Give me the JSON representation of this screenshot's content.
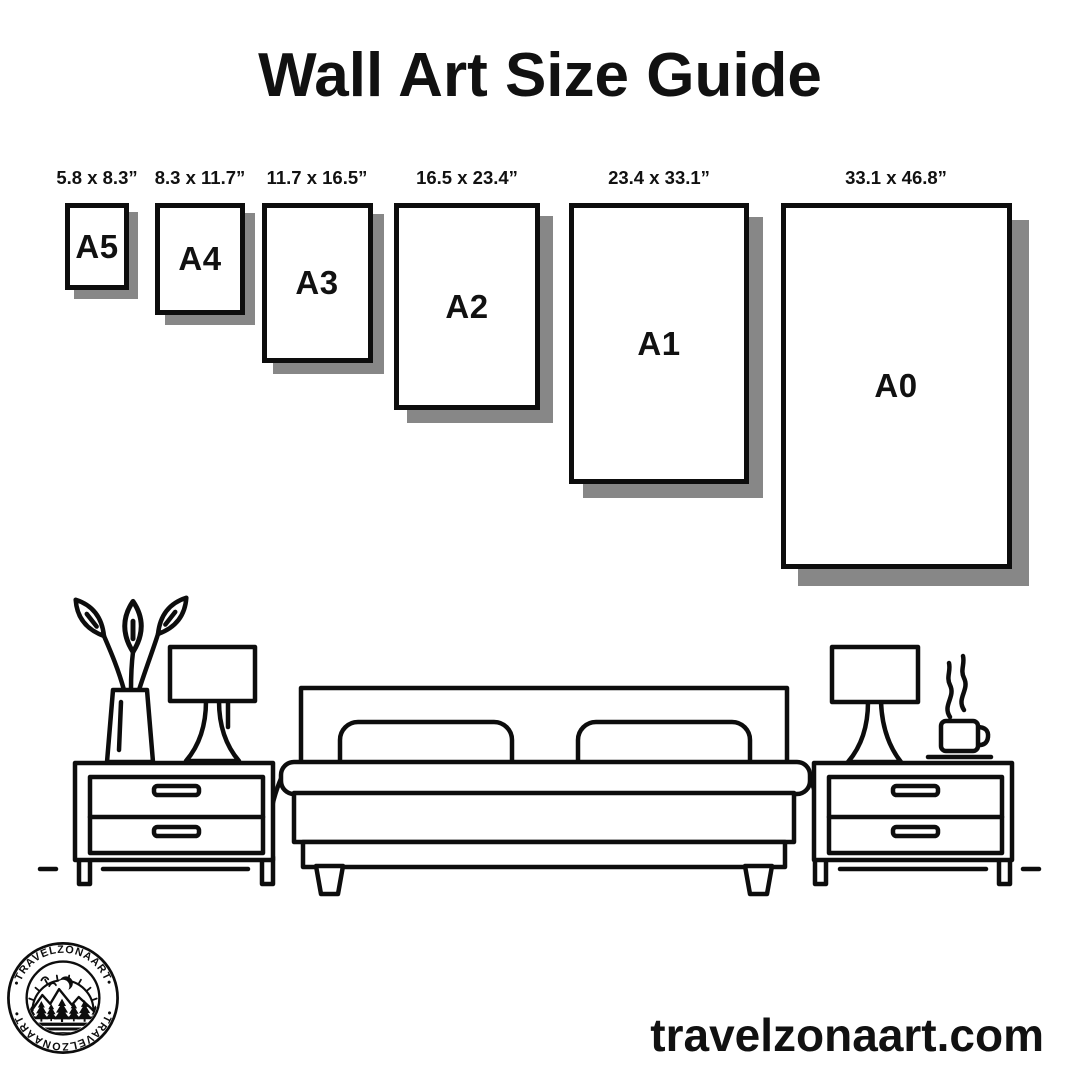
{
  "header": {
    "title": "Wall Art Size Guide"
  },
  "papers": [
    {
      "name": "A5",
      "dims": "5.8 x 8.3”"
    },
    {
      "name": "A4",
      "dims": "8.3 x 11.7”"
    },
    {
      "name": "A3",
      "dims": "11.7 x 16.5”"
    },
    {
      "name": "A2",
      "dims": "16.5 x 23.4”"
    },
    {
      "name": "A1",
      "dims": "23.4 x 33.1”"
    },
    {
      "name": "A0",
      "dims": "33.1 x 46.8”"
    }
  ],
  "logo": {
    "badge_text": "•TRAVELZONAART•"
  },
  "footer": {
    "website": "travelzonaart.com"
  },
  "colors": {
    "ink": "#0d0d0d",
    "shadow": "#878787",
    "background": "#ffffff"
  },
  "scene": {
    "icons": [
      "plant-vase-icon",
      "table-lamp-icon",
      "bed-icon",
      "nightstand-icon",
      "coffee-cup-icon",
      "steam-icon"
    ]
  }
}
